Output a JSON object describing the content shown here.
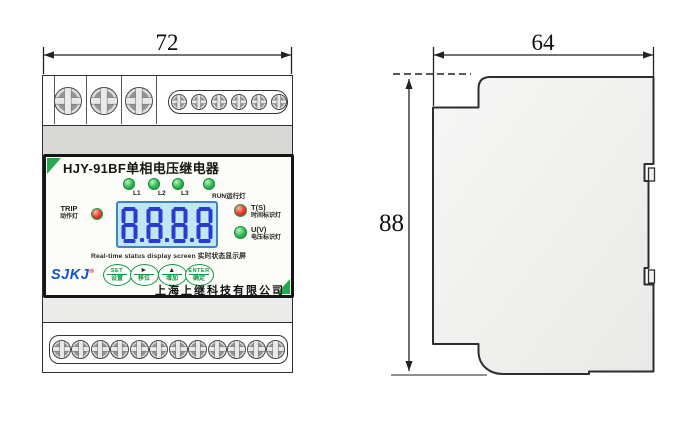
{
  "front_view": {
    "dimension_width": "72",
    "title": "HJY-91BF单相电压继电器",
    "leds": [
      {
        "label": "L1"
      },
      {
        "label": "L2"
      },
      {
        "label": "L3"
      },
      {
        "label": "RUN运行灯"
      }
    ],
    "trip_indicator": {
      "line1": "TRIP",
      "line2": "动作灯"
    },
    "time_indicator": {
      "line1": "T(S)",
      "line2": "时间标识灯"
    },
    "voltage_indicator": {
      "line1": "U(V)",
      "line2": "电压标识灯"
    },
    "display": {
      "value": "8.8.8.8",
      "caption": "Real-time status display screen 实时状态显示屏"
    },
    "buttons": [
      {
        "top": "SET",
        "bottom": "设置"
      },
      {
        "top": "►",
        "bottom": "移位"
      },
      {
        "top": "▲",
        "bottom": "增加"
      },
      {
        "top": "ENTER",
        "bottom": "确定"
      }
    ],
    "brand": {
      "logo": "SJKJ",
      "registered": "®",
      "company": "上海上继科技有限公司"
    },
    "terminals": {
      "top_large_screws": 3,
      "top_small_screws": 6,
      "bottom_screws": 12
    }
  },
  "side_view": {
    "dimension_width": "64",
    "dimension_height": "88"
  },
  "colors": {
    "accent_green": "#0d9a40",
    "led_green": "#2db84d",
    "led_red": "#e63327",
    "logo_blue": "#1254c8",
    "lcd_bg": "#bfe7f5",
    "lcd_digit": "#2b3ad0",
    "panel_border": "#151515"
  }
}
